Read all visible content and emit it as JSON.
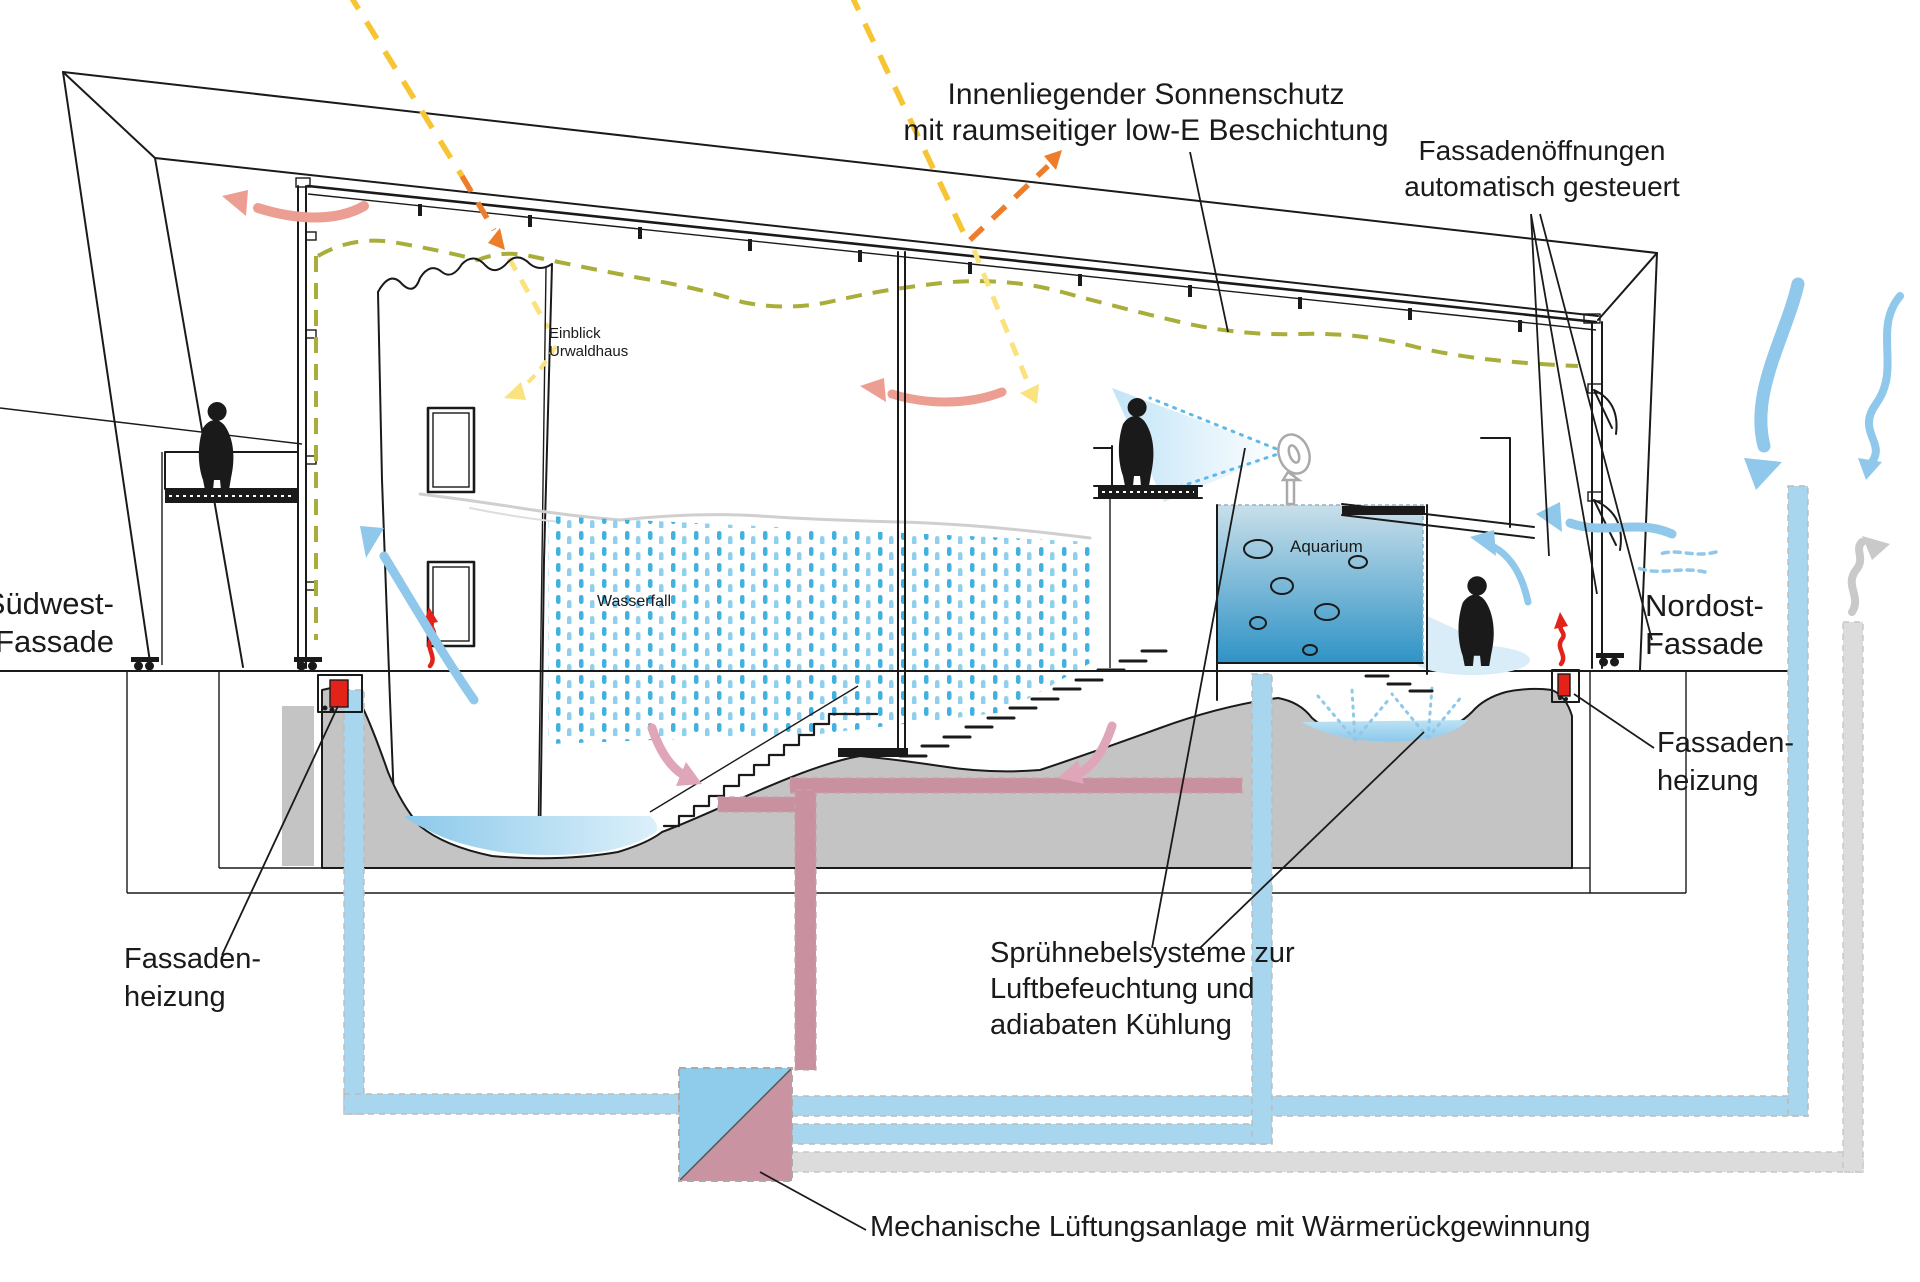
{
  "labels": {
    "sonnenschutz_1": "Innenliegender Sonnenschutz",
    "sonnenschutz_2": "mit raumseitiger low-E Beschichtung",
    "oeffnungen_1": "Fassadenöffnungen",
    "oeffnungen_2": "automatisch gesteuert",
    "suedwest_1": "Südwest-",
    "suedwest_2": "Fassade",
    "nordost_1": "Nordost-",
    "nordost_2": "Fassade",
    "einblick_1": "Einblick",
    "einblick_2": "Urwaldhaus",
    "wasserfall": "Wasserfall",
    "aquarium": "Aquarium",
    "heizung_links_1": "Fassaden-",
    "heizung_links_2": "heizung",
    "heizung_rechts_1": "Fassaden-",
    "heizung_rechts_2": "heizung",
    "nebel_1": "Sprühnebelsysteme zur",
    "nebel_2": "Luftbefeuchtung und",
    "nebel_3": "adiabaten Kühlung",
    "lueftung": "Mechanische Lüftungsanlage mit Wärmerückgewinnung"
  },
  "colors": {
    "ink": "#1a1a1a",
    "arrow_blue": "#8fc8ea",
    "pipe_blue": "#a9d6ef",
    "pipe_gray": "#dcdcdc",
    "rain_blue": "#41b1e2",
    "rain_blue2": "#8fd0ee",
    "water_light": "#bce2f5",
    "pond_left": "#8cc9ea",
    "pond_right": "#dcf0fa",
    "salmon": "#ec9e92",
    "pink": "#dfa5b9",
    "duct_pink": "#c9909f",
    "hx_blue": "#8fcbea",
    "hx_pink": "#ca93a2",
    "terrain": "#c4c4c4",
    "red": "#e32219",
    "olive": "#a9ae3b",
    "sun_yellow": "#f7c433",
    "sun_orange": "#ed7d2b",
    "sun_pale": "#fae27e",
    "mist": "#bfe3f7",
    "aq_top": "#c9dfea",
    "aq_bottom": "#2f93c6",
    "gray_arrow": "#c9c9c9"
  }
}
